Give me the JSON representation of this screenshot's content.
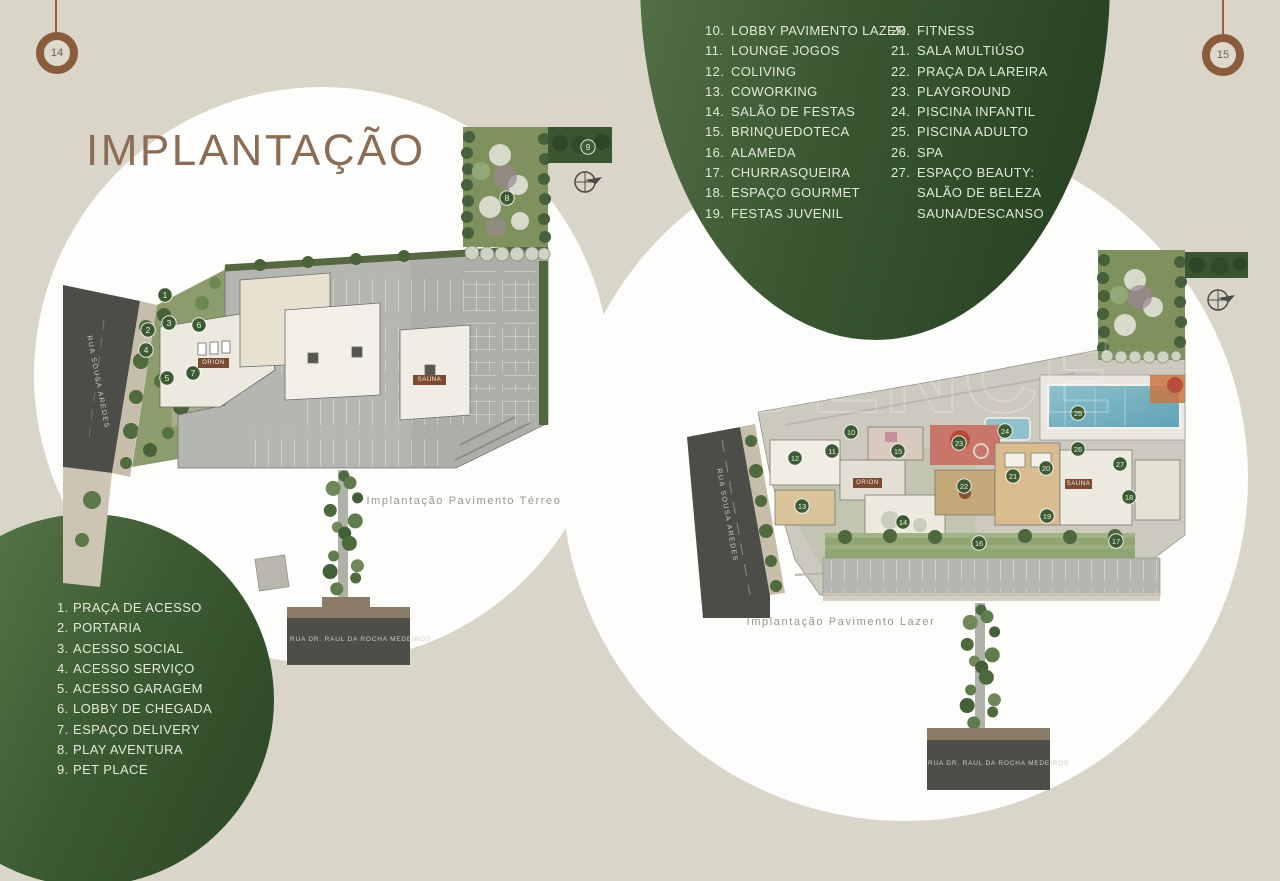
{
  "page": {
    "number_left": "14",
    "number_right": "15"
  },
  "title": "IMPLANTAÇÃO",
  "watermark": "EVIDENCE",
  "colors": {
    "background": "#d9d5c9",
    "green_dark": "#243e20",
    "green_light": "#5e7a4f",
    "title_brown": "#8b6c55",
    "ring_brown": "#8a5c3b",
    "legend_text": "#e3e9da",
    "road": "#4c4c48",
    "marker_green": "#3d5b33",
    "tower_label_bg": "#7c4a31"
  },
  "legend_access": [
    {
      "num": "1.",
      "label": "PRAÇA DE ACESSO"
    },
    {
      "num": "2.",
      "label": "PORTARIA"
    },
    {
      "num": "3.",
      "label": "ACESSO SOCIAL"
    },
    {
      "num": "4.",
      "label": "ACESSO SERVIÇO"
    },
    {
      "num": "5.",
      "label": "ACESSO GARAGEM"
    },
    {
      "num": "6.",
      "label": "LOBBY DE CHEGADA"
    },
    {
      "num": "7.",
      "label": "ESPAÇO DELIVERY"
    },
    {
      "num": "8.",
      "label": "PLAY AVENTURA"
    },
    {
      "num": "9.",
      "label": "PET PLACE"
    }
  ],
  "legend_leisure_col1": [
    {
      "num": "10.",
      "label": "LOBBY PAVIMENTO LAZER"
    },
    {
      "num": "11.",
      "label": "LOUNGE JOGOS"
    },
    {
      "num": "12.",
      "label": "COLIVING"
    },
    {
      "num": "13.",
      "label": "COWORKING"
    },
    {
      "num": "14.",
      "label": "SALÃO DE FESTAS"
    },
    {
      "num": "15.",
      "label": "BRINQUEDOTECA"
    },
    {
      "num": "16.",
      "label": "ALAMEDA"
    },
    {
      "num": "17.",
      "label": "CHURRASQUEIRA"
    },
    {
      "num": "18.",
      "label": "ESPAÇO GOURMET"
    },
    {
      "num": "19.",
      "label": "FESTAS JUVENIL"
    }
  ],
  "legend_leisure_col2": [
    {
      "num": "20.",
      "label": "FITNESS"
    },
    {
      "num": "21.",
      "label": "SALA MULTIÚSO"
    },
    {
      "num": "22.",
      "label": "PRAÇA DA LAREIRA"
    },
    {
      "num": "23.",
      "label": "PLAYGROUND"
    },
    {
      "num": "24.",
      "label": "PISCINA INFANTIL"
    },
    {
      "num": "25.",
      "label": "PISCINA ADULTO"
    },
    {
      "num": "26.",
      "label": "SPA"
    },
    {
      "num": "27.",
      "label": "ESPAÇO BEAUTY:"
    },
    {
      "num": "",
      "label": "SALÃO DE BELEZA"
    },
    {
      "num": "",
      "label": "SAUNA/DESCANSO"
    }
  ],
  "plan_terreo": {
    "caption": "Implantação Pavimento Térreo",
    "street_side": "RUA SOUSA AREDES",
    "street_bottom": "RUA DR. RAUL DA ROCHA MEDEIROS",
    "label_orion": "ORION",
    "label_sauna": "SAUNA",
    "markers": [
      {
        "n": "1",
        "x": 105,
        "y": 180
      },
      {
        "n": "2",
        "x": 88,
        "y": 215
      },
      {
        "n": "3",
        "x": 109,
        "y": 208
      },
      {
        "n": "4",
        "x": 86,
        "y": 235
      },
      {
        "n": "5",
        "x": 107,
        "y": 263
      },
      {
        "n": "6",
        "x": 139,
        "y": 210
      },
      {
        "n": "7",
        "x": 133,
        "y": 258
      },
      {
        "n": "8",
        "x": 447,
        "y": 83
      },
      {
        "n": "9",
        "x": 528,
        "y": 32
      }
    ]
  },
  "plan_lazer": {
    "caption": "Implantação Pavimento Lazer",
    "street_side": "RUA SOUSA AREDES",
    "street_bottom": "RUA DR. RAUL DA ROCHA MEDEIROS",
    "label_orion": "ORION",
    "label_sauna": "SAUNA",
    "markers": [
      {
        "n": "10",
        "x": 176,
        "y": 207
      },
      {
        "n": "11",
        "x": 157,
        "y": 226
      },
      {
        "n": "12",
        "x": 120,
        "y": 233
      },
      {
        "n": "13",
        "x": 127,
        "y": 281
      },
      {
        "n": "14",
        "x": 228,
        "y": 297
      },
      {
        "n": "15",
        "x": 223,
        "y": 226
      },
      {
        "n": "16",
        "x": 304,
        "y": 318
      },
      {
        "n": "17",
        "x": 441,
        "y": 316
      },
      {
        "n": "18",
        "x": 454,
        "y": 272
      },
      {
        "n": "19",
        "x": 372,
        "y": 291
      },
      {
        "n": "20",
        "x": 371,
        "y": 243
      },
      {
        "n": "21",
        "x": 338,
        "y": 251
      },
      {
        "n": "22",
        "x": 289,
        "y": 261
      },
      {
        "n": "23",
        "x": 284,
        "y": 218
      },
      {
        "n": "24",
        "x": 330,
        "y": 206
      },
      {
        "n": "25",
        "x": 403,
        "y": 188
      },
      {
        "n": "26",
        "x": 403,
        "y": 224
      },
      {
        "n": "27",
        "x": 445,
        "y": 239
      }
    ]
  }
}
